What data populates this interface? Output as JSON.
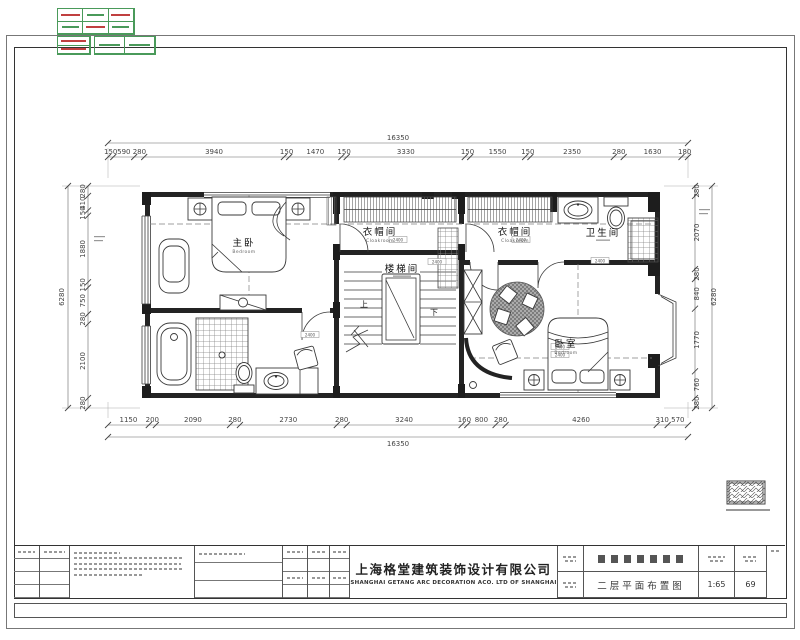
{
  "dims": {
    "top": {
      "total": "16350",
      "values": [
        "150",
        "590",
        "280",
        "3940",
        "150",
        "1470",
        "150",
        "3330",
        "150",
        "1550",
        "150",
        "2350",
        "280",
        "1630",
        "180"
      ]
    },
    "bottom": {
      "total": "16350",
      "values": [
        "1150",
        "200",
        "2090",
        "280",
        "2730",
        "280",
        "3240",
        "160",
        "800",
        "280",
        "4260",
        "310",
        "570"
      ]
    },
    "left": {
      "total": "6280",
      "values": [
        "280",
        "410",
        "150",
        "1880",
        "150",
        "750",
        "280",
        "2100",
        "280"
      ]
    },
    "right": {
      "total": "6280",
      "values": [
        "280",
        "2070",
        "280",
        "840",
        "1770",
        "760",
        "280"
      ]
    }
  },
  "rooms": {
    "master": {
      "name": "主卧",
      "sub": "Bedroom"
    },
    "cloak1": {
      "name": "衣帽间",
      "sub": "Cloakroom"
    },
    "cloak2": {
      "name": "衣帽间",
      "sub": "Cloakroom"
    },
    "stair": {
      "name": "楼梯间"
    },
    "bath": {
      "name": "卫生间"
    },
    "bedroom2": {
      "name": "卧室",
      "sub": "Bedroom"
    },
    "up": "上",
    "down": "下"
  },
  "door_tag": "2400",
  "titleblock": {
    "company_cn": "上海格堂建筑装饰设计有限公司",
    "company_en": "SHANGHAI GETANG ARC DECORATION ACO. LTD OF SHANGHAI",
    "drawing_title": "二层平面布置图",
    "scale_value": "1:65",
    "sheet_no": "69"
  },
  "colors": {
    "stamp_green": "#4a9a5a",
    "stamp_red": "#c04040",
    "line": "#232323"
  }
}
